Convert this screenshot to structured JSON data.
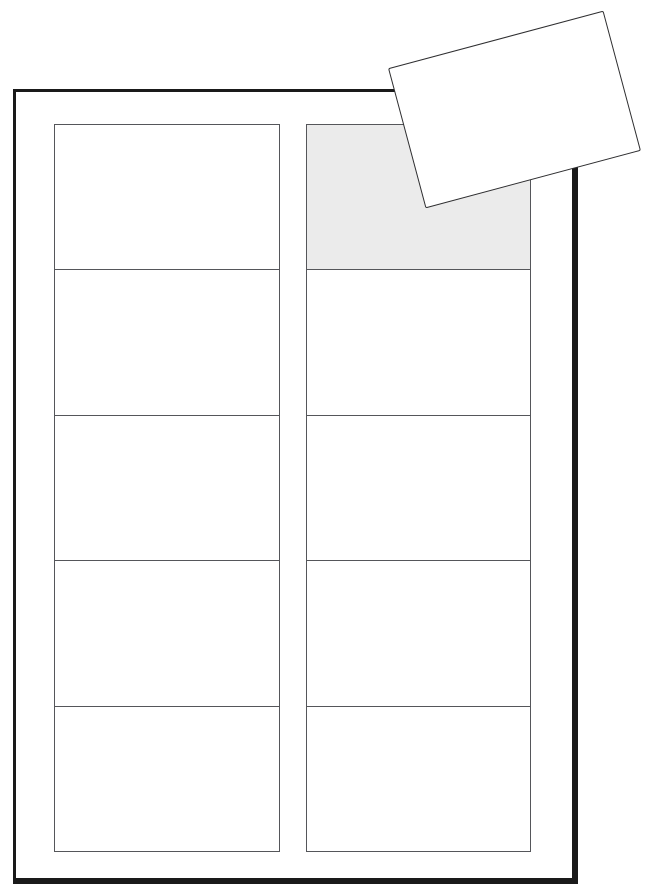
{
  "image": {
    "description": "Blank self-adhesive label sheet, 2 columns by 5 rows of rectangular labels; the top-right label is peeled off the sheet, leaving a gray backing spot, and is shown lifted and tilted over the sheet's top-right corner"
  },
  "sheet": {
    "columns": 2,
    "rows": 5,
    "total_labels": 10,
    "peeled": {
      "column": 2,
      "row": 1,
      "position": "top-right",
      "rotation_deg": -15
    }
  },
  "colors": {
    "page_background": "#ffffff",
    "sheet_fill": "#ffffff",
    "sheet_border": "#1a1a1a",
    "label_outline": "#55565a",
    "peeled_spot_fill": "#ebebeb",
    "peeled_label_fill": "#ffffff",
    "peeled_label_border": "#2e2e30"
  }
}
